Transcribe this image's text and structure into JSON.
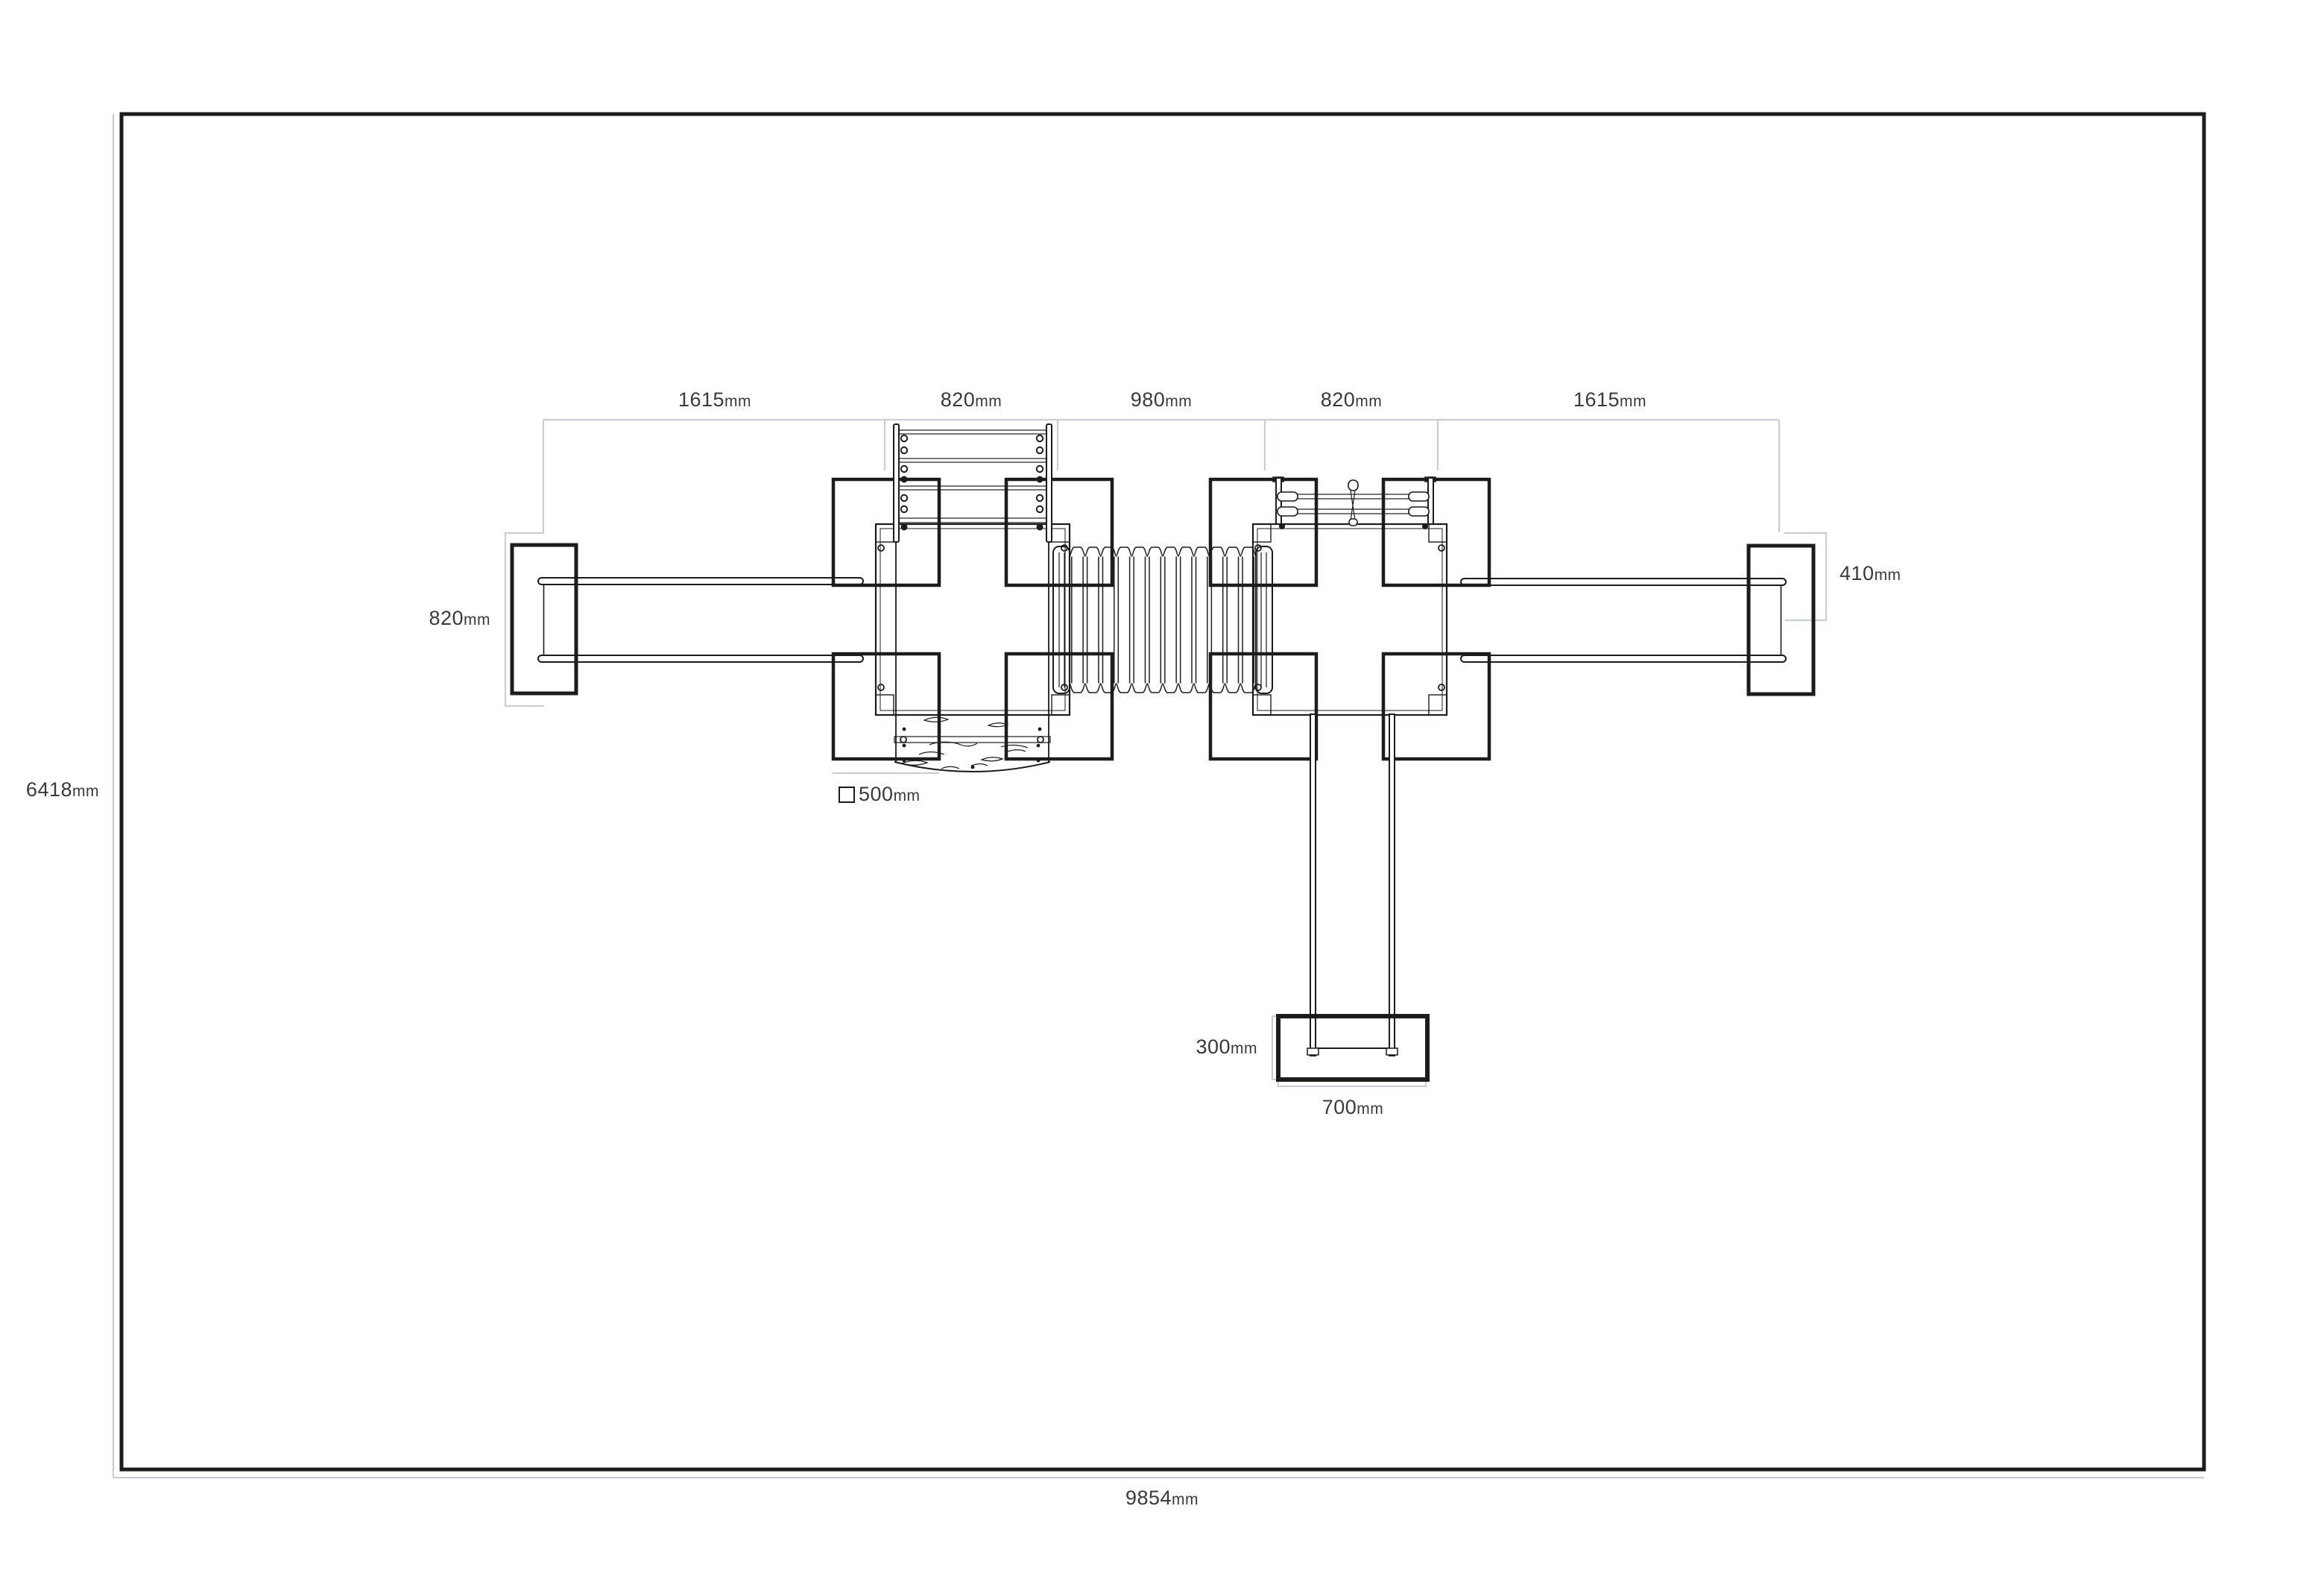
{
  "unit": "mm",
  "drawing_type": "playground-equipment-plan-view",
  "colors": {
    "line": "#1c1c1c",
    "dimension_line": "#c9ced2",
    "text": "#3a3a3a",
    "background": "#ffffff"
  },
  "top_dimensions": [
    {
      "value": "1615"
    },
    {
      "value": "820"
    },
    {
      "value": "980"
    },
    {
      "value": "820"
    },
    {
      "value": "1615"
    }
  ],
  "side_dimensions": {
    "monkey_bar_end_width": "820",
    "right_rail_end_width": "410",
    "overall_depth": "6418",
    "overall_width": "9854",
    "slide_exit_depth": "300",
    "slide_exit_width": "700"
  },
  "legend": {
    "post_size": "500"
  }
}
